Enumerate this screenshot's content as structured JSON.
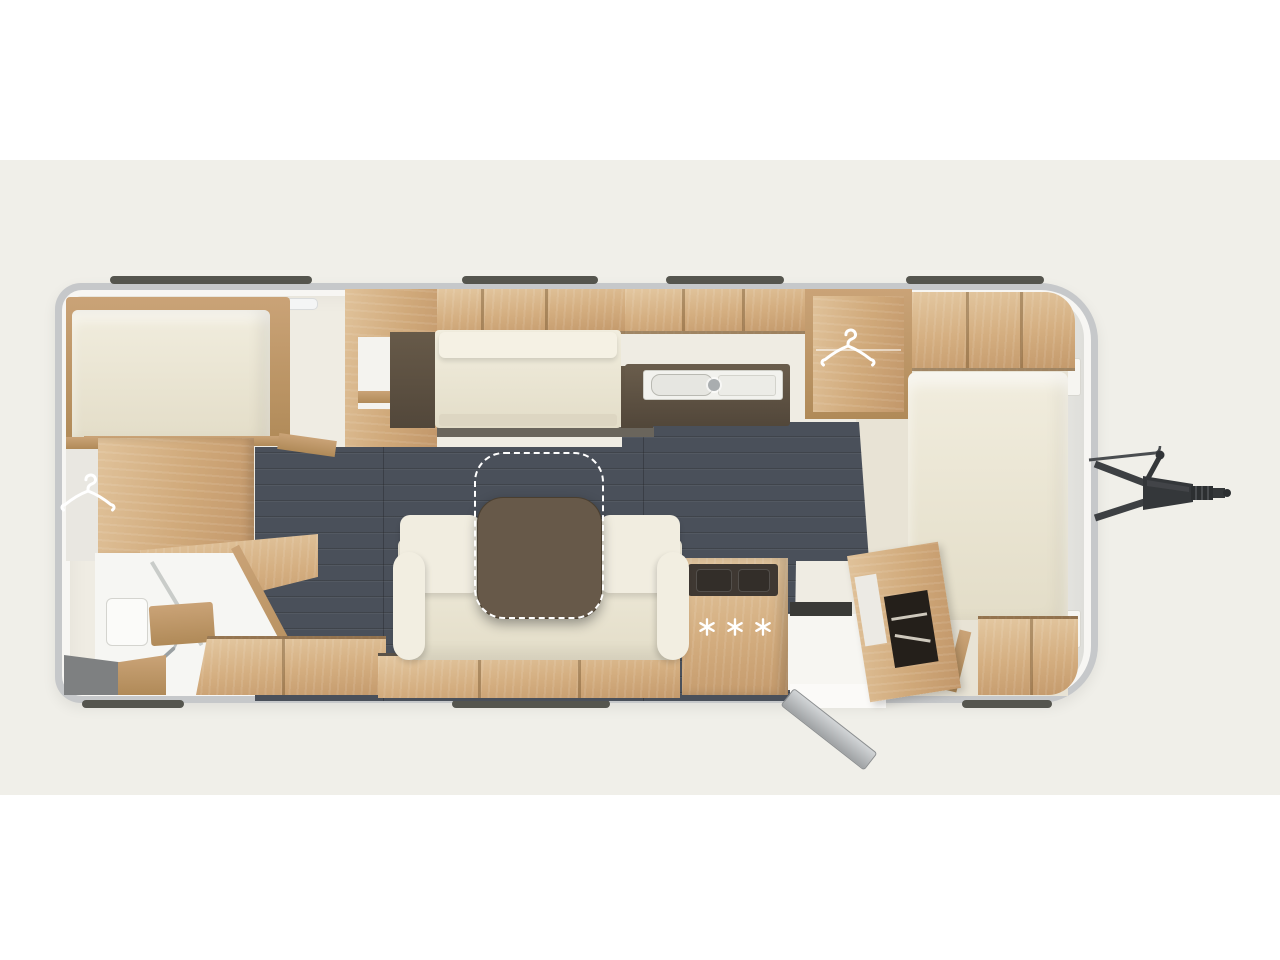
{
  "scene": {
    "type": "caravan-floor-plan",
    "view": "top-down",
    "hitch_side": "right",
    "visible_text": ""
  },
  "colors": {
    "page_background": "#ffffff",
    "band_background": "#f0efe9",
    "shell_gray": "#c6c8ca",
    "interior_base": "#efece3",
    "floor_dark": "#4a505a",
    "wood": "#d4ae80",
    "wood_dark": "#b08a58",
    "upholstery_cream": "#ece7d7",
    "counter_dark": "#5d5142",
    "table_brown": "#675949",
    "icon_white": "#ffffff",
    "hitch_dark": "#35383b"
  },
  "icons": {
    "hanger": "clothes-hanger-icon",
    "hanger_count": 2,
    "shower": "shower-head-icon",
    "burner": "six-spoke-asterisk-burner-icon"
  },
  "stove": {
    "burner_symbol": "✳",
    "burner_count": 3
  },
  "roof_rails": {
    "top_segments": 4,
    "bottom_segments": 3
  },
  "features": [
    "rear-double-bed",
    "rear-wardrobe-with-hanger",
    "bathroom-with-shower",
    "step-platform",
    "lounge-sofa",
    "movable-table-with-dashed-extension",
    "overhead-lockers",
    "kitchen-sink-unit",
    "stove-island-three-burners",
    "open-entry-door",
    "tall-cabinet-open",
    "front-bed",
    "mid-wardrobe-with-hanger",
    "tow-hitch"
  ]
}
